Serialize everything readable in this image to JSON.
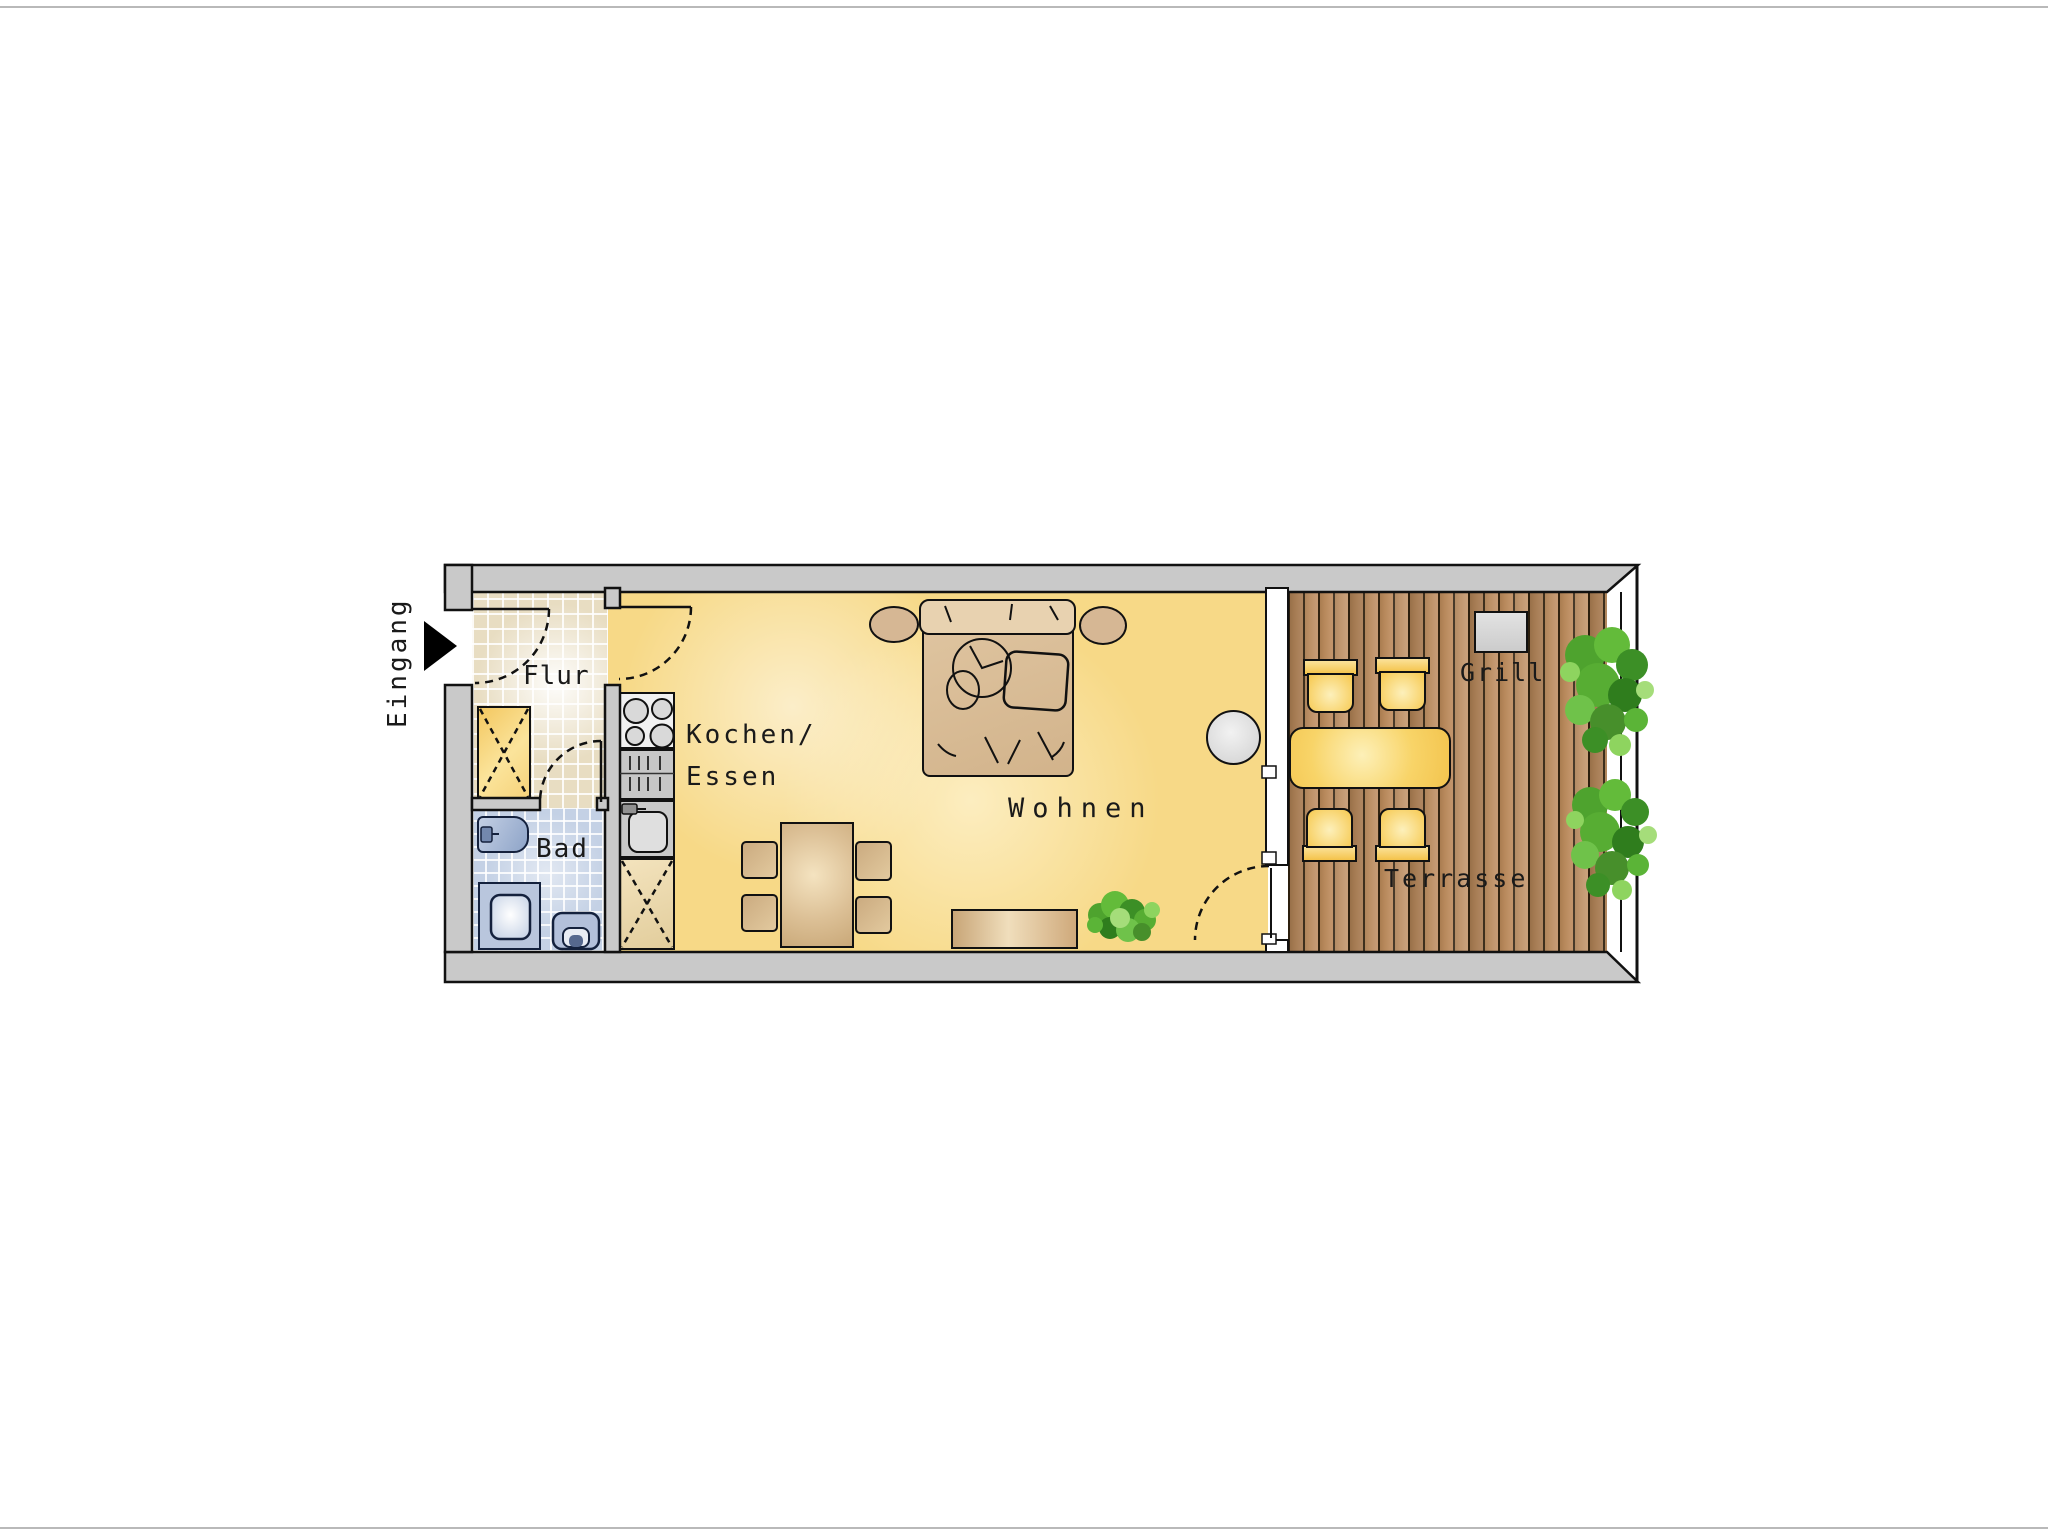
{
  "floorplan": {
    "entrance_label": "Eingang",
    "rooms": {
      "hall_label": "Flur",
      "bath_label": "Bad",
      "kitchen_label_line1": "Kochen/",
      "kitchen_label_line2": "Essen",
      "living_label": "Wohnen",
      "terrace_label": "Terrasse",
      "grill_label": "Grill"
    },
    "colors": {
      "wall_gray": "#c9c9c9",
      "outline_black": "#111111",
      "floor_living_yellow": "#f7d987",
      "floor_hall_tile": "#e8ddc2",
      "floor_bath_tile": "#c4d1e5",
      "terrace_wood_brown": "#b8895c",
      "armchair_green": "#93c948",
      "furniture_tan": "#d2b38b",
      "terrace_furniture_yellow": "#f6c84e",
      "bath_fixture_blue": "#8ea4c8",
      "grill_gray": "#d6d6d6",
      "plant_green": "#57ad33"
    },
    "furniture_icons": {
      "hall": [
        "wardrobe-icon",
        "entrance-door-icon"
      ],
      "bath": [
        "washbasin-icon",
        "shower-icon",
        "toilet-icon"
      ],
      "kitchen": [
        "stove-icon",
        "drawer-unit-icon",
        "kitchen-sink-icon",
        "tall-cabinet-icon",
        "dining-table-icon",
        "dining-chair-icon"
      ],
      "living": [
        "double-bed-icon",
        "nightstand-icon",
        "armchair-icon",
        "round-side-table-icon",
        "sideboard-icon",
        "plant-icon"
      ],
      "terrace": [
        "terrace-table-icon",
        "terrace-chair-icon",
        "grill-icon",
        "plant-icon",
        "railing-icon"
      ]
    }
  }
}
